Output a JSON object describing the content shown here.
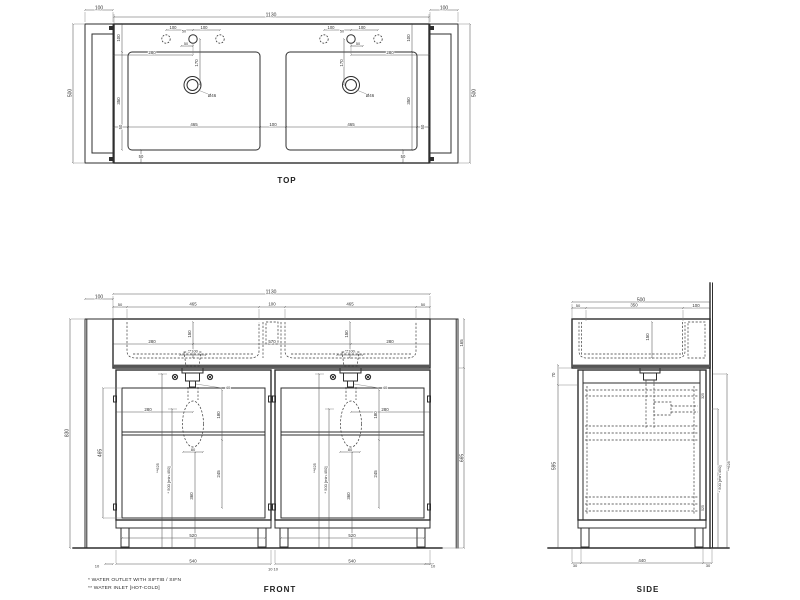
{
  "colors": {
    "line": "#2e2e2e",
    "dim": "#555555",
    "text": "#333333",
    "background": "#ffffff"
  },
  "footnotes": {
    "line1": "*  WATER OUTLET WITH SIFTIB / SIFN",
    "line2": "** WATER INLET [HOT-COLD]"
  },
  "views": {
    "top": {
      "title": "TOP",
      "labels": [
        {
          "t": "100",
          "x": 99,
          "y": 8
        },
        {
          "t": "1130",
          "x": 271,
          "y": 15
        },
        {
          "t": "100",
          "x": 444,
          "y": 8
        },
        {
          "t": "500",
          "x": 70,
          "y": 93,
          "r": -90
        },
        {
          "t": "500",
          "x": 474,
          "y": 93,
          "r": -90
        },
        {
          "t": "100",
          "x": 119,
          "y": 38,
          "r": -90,
          "s": 4.4
        },
        {
          "t": "350",
          "x": 119,
          "y": 101,
          "r": -90,
          "s": 4.4
        },
        {
          "t": "100",
          "x": 409,
          "y": 38,
          "r": -90,
          "s": 4.4
        },
        {
          "t": "350",
          "x": 409,
          "y": 101,
          "r": -90,
          "s": 4.4
        },
        {
          "t": "100",
          "x": 173,
          "y": 28,
          "s": 4.2
        },
        {
          "t": "50",
          "x": 184,
          "y": 31.5,
          "s": 3.8
        },
        {
          "t": "100",
          "x": 204,
          "y": 28,
          "s": 4.2
        },
        {
          "t": "50",
          "x": 186,
          "y": 44,
          "s": 3.8
        },
        {
          "t": "280",
          "x": 152,
          "y": 53,
          "s": 4.4
        },
        {
          "t": "170",
          "x": 197,
          "y": 63,
          "r": -90,
          "s": 4.4
        },
        {
          "t": "Ø46",
          "x": 212,
          "y": 96,
          "s": 4.4
        },
        {
          "t": "100",
          "x": 331,
          "y": 28,
          "s": 4.2
        },
        {
          "t": "50",
          "x": 342,
          "y": 31.5,
          "s": 3.8
        },
        {
          "t": "100",
          "x": 362,
          "y": 28,
          "s": 4.2
        },
        {
          "t": "50",
          "x": 358,
          "y": 44,
          "s": 3.8
        },
        {
          "t": "280",
          "x": 390,
          "y": 53,
          "s": 4.4
        },
        {
          "t": "170",
          "x": 342,
          "y": 63,
          "r": -90,
          "s": 4.4
        },
        {
          "t": "Ø46",
          "x": 370,
          "y": 96,
          "s": 4.4
        },
        {
          "t": "50",
          "x": 121,
          "y": 127,
          "r": -90,
          "s": 4.2
        },
        {
          "t": "465",
          "x": 194,
          "y": 125,
          "s": 4.4
        },
        {
          "t": "100",
          "x": 273,
          "y": 125,
          "s": 4.4
        },
        {
          "t": "465",
          "x": 351,
          "y": 125,
          "s": 4.4
        },
        {
          "t": "50",
          "x": 423,
          "y": 127,
          "r": -90,
          "s": 4.2
        },
        {
          "t": "50",
          "x": 141,
          "y": 157,
          "s": 4.2
        },
        {
          "t": "50",
          "x": 403,
          "y": 157,
          "s": 4.2
        }
      ]
    },
    "front": {
      "title": "FRONT",
      "labels": [
        {
          "t": "100",
          "x": 99,
          "y": 297
        },
        {
          "t": "1130",
          "x": 271,
          "y": 292
        },
        {
          "t": "50",
          "x": 120,
          "y": 305,
          "s": 4
        },
        {
          "t": "465",
          "x": 193,
          "y": 304.5,
          "s": 4.4
        },
        {
          "t": "100",
          "x": 272,
          "y": 304.5,
          "s": 4.4
        },
        {
          "t": "465",
          "x": 350,
          "y": 304.5,
          "s": 4.4
        },
        {
          "t": "50",
          "x": 423,
          "y": 305,
          "s": 4
        },
        {
          "t": "830",
          "x": 67,
          "y": 433,
          "r": -90
        },
        {
          "t": "150",
          "x": 190,
          "y": 334,
          "r": -90,
          "s": 4.4
        },
        {
          "t": "150",
          "x": 347,
          "y": 334,
          "r": -90,
          "s": 4.4
        },
        {
          "t": "280",
          "x": 152,
          "y": 342,
          "s": 4.4
        },
        {
          "t": "570",
          "x": 272,
          "y": 342,
          "s": 4.4
        },
        {
          "t": "280",
          "x": 390,
          "y": 342,
          "s": 4.4
        },
        {
          "t": "**100",
          "x": 193,
          "y": 351.5,
          "s": 4
        },
        {
          "t": "**100",
          "x": 350,
          "y": 351.5,
          "s": 4
        },
        {
          "t": "40",
          "x": 228,
          "y": 388,
          "s": 4
        },
        {
          "t": "40",
          "x": 385,
          "y": 388,
          "s": 4
        },
        {
          "t": "280",
          "x": 148,
          "y": 410,
          "s": 4.4
        },
        {
          "t": "280",
          "x": 385,
          "y": 410,
          "s": 4.4
        },
        {
          "t": "180",
          "x": 219,
          "y": 415,
          "r": -90,
          "s": 4.4
        },
        {
          "t": "180",
          "x": 376,
          "y": 415,
          "r": -90,
          "s": 4.4
        },
        {
          "t": "465",
          "x": 100,
          "y": 453,
          "r": -90
        },
        {
          "t": "**625",
          "x": 158,
          "y": 468,
          "r": -90,
          "s": 4
        },
        {
          "t": "* 500 [min 450]",
          "x": 169,
          "y": 480,
          "r": -90,
          "s": 4
        },
        {
          "t": "**625",
          "x": 315,
          "y": 468,
          "r": -90,
          "s": 4
        },
        {
          "t": "* 500 [min 450]",
          "x": 326,
          "y": 480,
          "r": -90,
          "s": 4
        },
        {
          "t": "80",
          "x": 193,
          "y": 450,
          "s": 4
        },
        {
          "t": "80",
          "x": 350,
          "y": 450,
          "s": 4
        },
        {
          "t": "245",
          "x": 219,
          "y": 474,
          "r": -90,
          "s": 4.4
        },
        {
          "t": "245",
          "x": 376,
          "y": 474,
          "r": -90,
          "s": 4.4
        },
        {
          "t": "360",
          "x": 192,
          "y": 496,
          "r": -90,
          "s": 4.4
        },
        {
          "t": "360",
          "x": 349,
          "y": 496,
          "r": -90,
          "s": 4.4
        },
        {
          "t": "520",
          "x": 193,
          "y": 536,
          "s": 4.4
        },
        {
          "t": "520",
          "x": 352,
          "y": 536,
          "s": 4.4
        },
        {
          "t": "540",
          "x": 193,
          "y": 561.5,
          "s": 4.4
        },
        {
          "t": "540",
          "x": 352,
          "y": 561.5,
          "s": 4.4
        },
        {
          "t": "10",
          "x": 97,
          "y": 566.5,
          "s": 4
        },
        {
          "t": "10 10",
          "x": 273,
          "y": 569.5,
          "s": 4
        },
        {
          "t": "10",
          "x": 433,
          "y": 566.5,
          "s": 4
        },
        {
          "t": "165",
          "x": 462,
          "y": 343,
          "r": -90,
          "s": 4.4
        },
        {
          "t": "665",
          "x": 462,
          "y": 458,
          "r": -90
        }
      ]
    },
    "side": {
      "title": "SIDE",
      "labels": [
        {
          "t": "500",
          "x": 641,
          "y": 300
        },
        {
          "t": "50",
          "x": 578,
          "y": 306,
          "s": 4
        },
        {
          "t": "350",
          "x": 634,
          "y": 305.5,
          "s": 4.4
        },
        {
          "t": "100",
          "x": 696,
          "y": 306,
          "s": 4.4
        },
        {
          "t": "150",
          "x": 648,
          "y": 337,
          "r": -90,
          "s": 4.4
        },
        {
          "t": "70",
          "x": 554,
          "y": 375,
          "r": -90,
          "s": 4.4
        },
        {
          "t": "595",
          "x": 554,
          "y": 466,
          "r": -90
        },
        {
          "t": "325",
          "x": 703,
          "y": 396,
          "r": -90,
          "s": 3.5
        },
        {
          "t": "525",
          "x": 703,
          "y": 508,
          "r": -90,
          "s": 3.5
        },
        {
          "t": "* 500 [min 450]",
          "x": 720,
          "y": 479,
          "r": -90,
          "s": 4
        },
        {
          "t": "**625",
          "x": 729,
          "y": 466,
          "r": -90,
          "s": 4
        },
        {
          "t": "30",
          "x": 575,
          "y": 566,
          "s": 4
        },
        {
          "t": "440",
          "x": 642,
          "y": 561,
          "s": 4.4
        },
        {
          "t": "30",
          "x": 708,
          "y": 566,
          "s": 4
        }
      ]
    }
  }
}
